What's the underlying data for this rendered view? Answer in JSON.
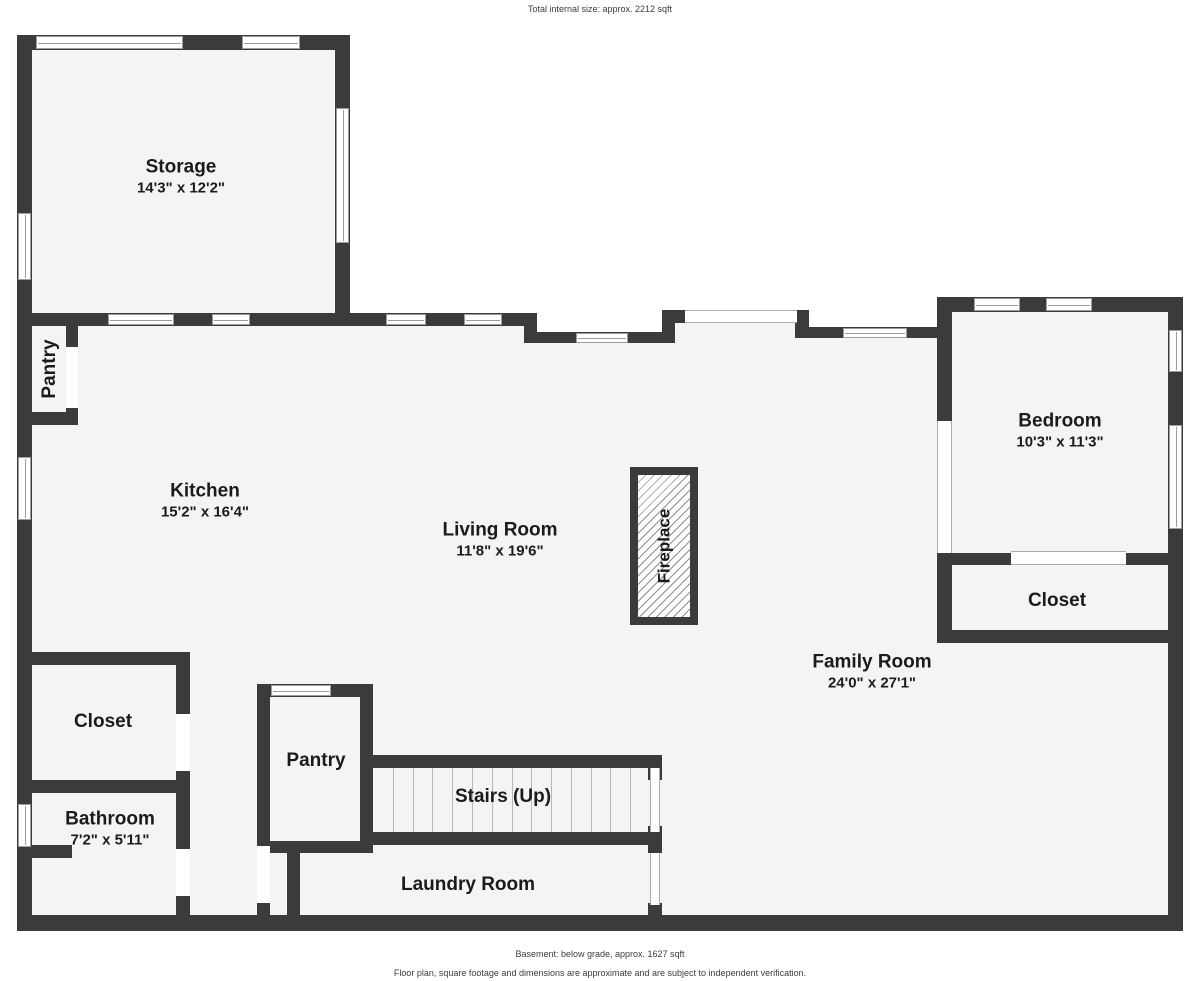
{
  "header": {
    "total_note": "Total internal size: approx. 2212 sqft"
  },
  "footer": {
    "line1": "Basement: below grade, approx. 1627 sqft",
    "line2": "Floor plan, square footage and dimensions are approximate and are subject to independent verification."
  },
  "colors": {
    "wall": "#3b3b3b",
    "floor": "#f4f4f4",
    "window_line": "#9c9c9c",
    "text": "#1b1b1b"
  },
  "rooms": [
    {
      "id": "storage",
      "label": "Storage",
      "dims": "14'3\" x 12'2\"",
      "cx": 181,
      "cy": 177,
      "vertical": false
    },
    {
      "id": "pantry-upper",
      "label": "Pantry",
      "dims": "",
      "cx": 50,
      "cy": 369,
      "vertical": true
    },
    {
      "id": "kitchen",
      "label": "Kitchen",
      "dims": "15'2\" x 16'4\"",
      "cx": 205,
      "cy": 501,
      "vertical": false
    },
    {
      "id": "living-room",
      "label": "Living Room",
      "dims": "11'8\" x 19'6\"",
      "cx": 500,
      "cy": 540,
      "vertical": false
    },
    {
      "id": "bedroom",
      "label": "Bedroom",
      "dims": "10'3\" x 11'3\"",
      "cx": 1060,
      "cy": 431,
      "vertical": false
    },
    {
      "id": "closet-bedroom",
      "label": "Closet",
      "dims": "",
      "cx": 1057,
      "cy": 601,
      "vertical": false
    },
    {
      "id": "family-room",
      "label": "Family Room",
      "dims": "24'0\" x 27'1\"",
      "cx": 872,
      "cy": 672,
      "vertical": false
    },
    {
      "id": "closet-hall",
      "label": "Closet",
      "dims": "",
      "cx": 103,
      "cy": 722,
      "vertical": false
    },
    {
      "id": "bathroom",
      "label": "Bathroom",
      "dims": "7'2\" x 5'11\"",
      "cx": 110,
      "cy": 829,
      "vertical": false
    },
    {
      "id": "pantry-lower",
      "label": "Pantry",
      "dims": "",
      "cx": 316,
      "cy": 761,
      "vertical": false
    },
    {
      "id": "stairs",
      "label": "Stairs (Up)",
      "dims": "",
      "cx": 503,
      "cy": 797,
      "vertical": false
    },
    {
      "id": "laundry-room",
      "label": "Laundry Room",
      "dims": "",
      "cx": 468,
      "cy": 885,
      "vertical": false
    }
  ],
  "geometry": {
    "fills": [
      [
        30,
        48,
        312,
        872
      ],
      [
        342,
        320,
        195,
        600
      ],
      [
        537,
        338,
        137,
        582
      ],
      [
        674,
        318,
        123,
        602
      ],
      [
        797,
        332,
        140,
        588
      ],
      [
        937,
        305,
        240,
        615
      ]
    ],
    "walls": [
      [
        17,
        35,
        15,
        895
      ],
      [
        17,
        35,
        333,
        15
      ],
      [
        335,
        35,
        15,
        290
      ],
      [
        17,
        313,
        520,
        13
      ],
      [
        524,
        313,
        13,
        30
      ],
      [
        524,
        332,
        150,
        11
      ],
      [
        662,
        313,
        13,
        30
      ],
      [
        662,
        310,
        25,
        13
      ],
      [
        795,
        310,
        14,
        28
      ],
      [
        806,
        327,
        134,
        11
      ],
      [
        937,
        297,
        246,
        15
      ],
      [
        1168,
        297,
        15,
        633
      ],
      [
        937,
        297,
        15,
        126
      ],
      [
        937,
        551,
        15,
        92
      ],
      [
        937,
        553,
        76,
        12
      ],
      [
        1124,
        553,
        59,
        12
      ],
      [
        937,
        630,
        246,
        13
      ],
      [
        17,
        915,
        1166,
        16
      ],
      [
        66,
        325,
        12,
        22
      ],
      [
        66,
        408,
        12,
        10
      ],
      [
        17,
        412,
        61,
        13
      ],
      [
        17,
        652,
        170,
        13
      ],
      [
        176,
        652,
        14,
        62
      ],
      [
        176,
        771,
        14,
        78
      ],
      [
        176,
        896,
        14,
        25
      ],
      [
        17,
        780,
        173,
        13
      ],
      [
        32,
        845,
        40,
        13
      ],
      [
        257,
        684,
        13,
        162
      ],
      [
        257,
        684,
        116,
        13
      ],
      [
        360,
        684,
        13,
        168
      ],
      [
        257,
        841,
        116,
        12
      ],
      [
        287,
        846,
        13,
        76
      ],
      [
        257,
        903,
        13,
        18
      ],
      [
        373,
        755,
        287,
        13
      ],
      [
        373,
        832,
        282,
        13
      ],
      [
        648,
        755,
        14,
        25
      ],
      [
        648,
        826,
        14,
        27
      ],
      [
        648,
        903,
        14,
        18
      ]
    ],
    "windows": [
      {
        "x": 36,
        "y": 36,
        "w": 147,
        "h": 13,
        "o": "h"
      },
      {
        "x": 242,
        "y": 36,
        "w": 58,
        "h": 13,
        "o": "h"
      },
      {
        "x": 108,
        "y": 314,
        "w": 66,
        "h": 11,
        "o": "h"
      },
      {
        "x": 212,
        "y": 314,
        "w": 38,
        "h": 11,
        "o": "h"
      },
      {
        "x": 386,
        "y": 314,
        "w": 40,
        "h": 11,
        "o": "h"
      },
      {
        "x": 464,
        "y": 314,
        "w": 38,
        "h": 11,
        "o": "h"
      },
      {
        "x": 576,
        "y": 333,
        "w": 52,
        "h": 10,
        "o": "h"
      },
      {
        "x": 843,
        "y": 328,
        "w": 64,
        "h": 10,
        "o": "h"
      },
      {
        "x": 974,
        "y": 298,
        "w": 46,
        "h": 13,
        "o": "h"
      },
      {
        "x": 1046,
        "y": 298,
        "w": 46,
        "h": 13,
        "o": "h"
      },
      {
        "x": 271,
        "y": 685,
        "w": 60,
        "h": 11,
        "o": "h"
      },
      {
        "x": 18,
        "y": 213,
        "w": 13,
        "h": 67,
        "o": "v"
      },
      {
        "x": 336,
        "y": 108,
        "w": 13,
        "h": 135,
        "o": "v"
      },
      {
        "x": 18,
        "y": 457,
        "w": 13,
        "h": 63,
        "o": "v"
      },
      {
        "x": 18,
        "y": 804,
        "w": 13,
        "h": 43,
        "o": "v"
      },
      {
        "x": 1169,
        "y": 330,
        "w": 13,
        "h": 42,
        "o": "v"
      },
      {
        "x": 1169,
        "y": 425,
        "w": 13,
        "h": 104,
        "o": "v"
      }
    ],
    "gaps": [
      [
        66,
        347,
        12,
        61
      ],
      [
        176,
        714,
        14,
        57
      ],
      [
        176,
        849,
        14,
        47
      ],
      [
        257,
        846,
        13,
        57
      ]
    ],
    "edges": [
      {
        "x": 685,
        "y": 310,
        "w": 112,
        "h": 13,
        "o": "h"
      },
      {
        "x": 1011,
        "y": 551,
        "w": 115,
        "h": 14,
        "o": "h"
      },
      {
        "x": 937,
        "y": 421,
        "w": 15,
        "h": 132,
        "o": "v"
      },
      {
        "x": 650,
        "y": 768,
        "w": 10,
        "h": 64,
        "o": "v"
      },
      {
        "x": 650,
        "y": 853,
        "w": 10,
        "h": 52,
        "o": "v"
      }
    ],
    "stairs": {
      "x": 373,
      "y": 768,
      "w": 277,
      "h": 64,
      "treads": 13
    },
    "fireplace": {
      "x": 630,
      "y": 467,
      "w": 68,
      "h": 158,
      "label": "Fireplace"
    }
  }
}
